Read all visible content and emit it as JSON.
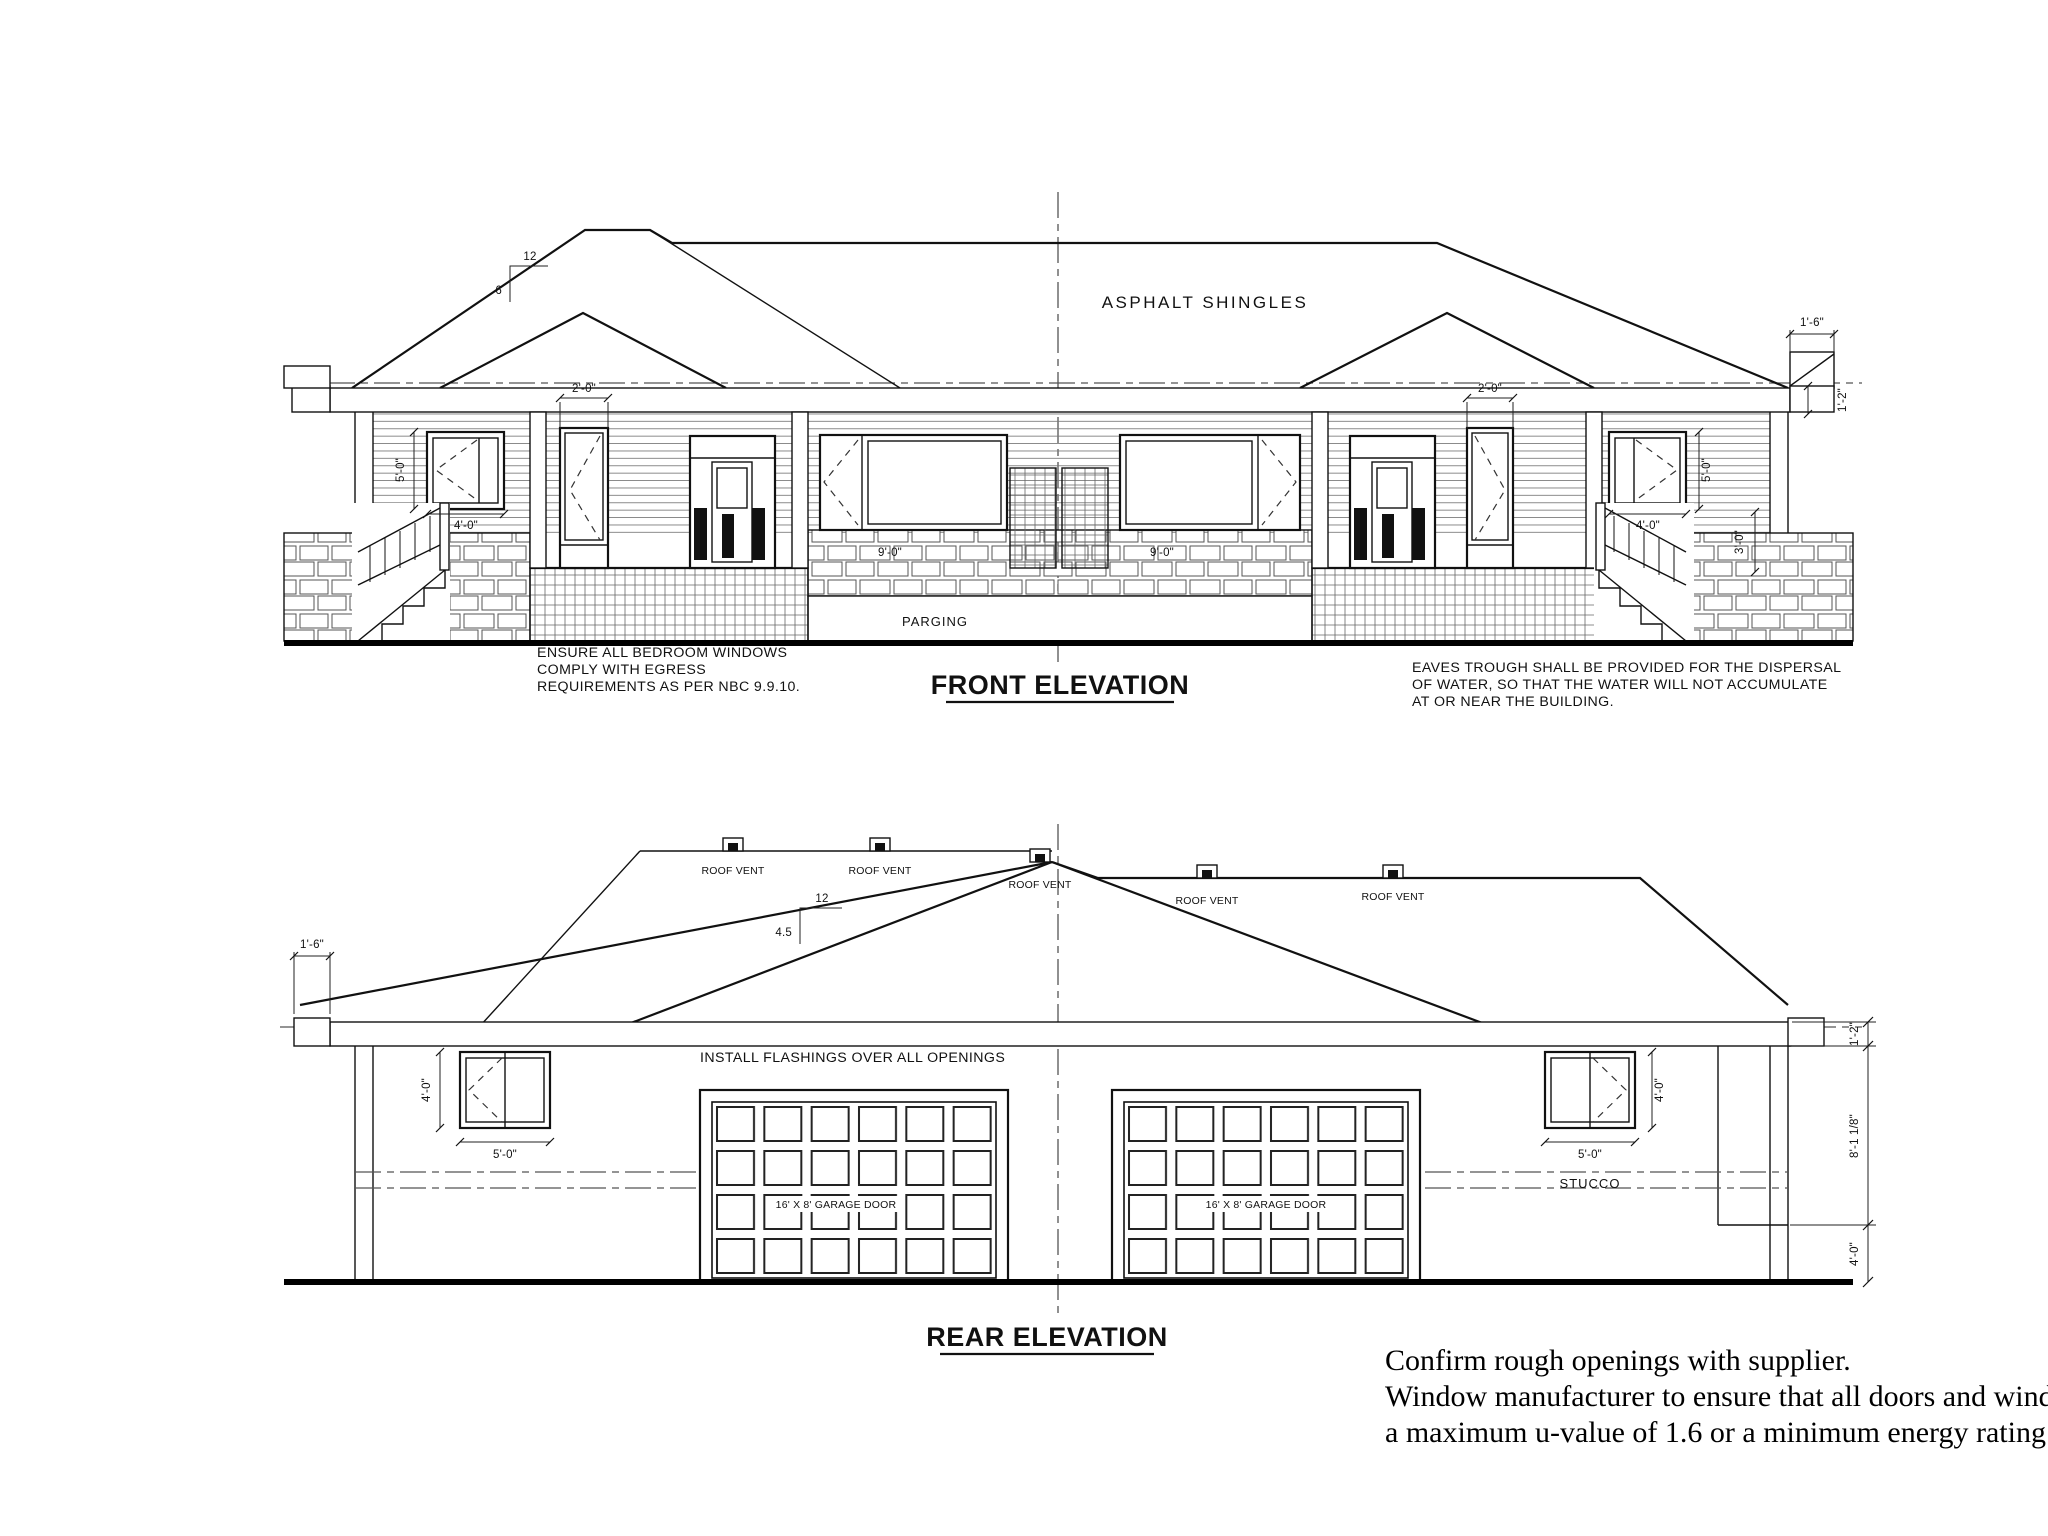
{
  "sheet": {
    "background": "#ffffff",
    "ink": "#111111"
  },
  "front": {
    "title": "FRONT ELEVATION",
    "roof_material": "ASPHALT SHINGLES",
    "parging": "PARGING",
    "slope_run": "12",
    "slope_rise": "6",
    "egress_note": [
      "ENSURE ALL BEDROOM WINDOWS",
      "COMPLY WITH EGRESS",
      "REQUIREMENTS AS PER NBC 9.9.10."
    ],
    "eaves_note": [
      "EAVES TROUGH SHALL BE PROVIDED FOR THE DISPERSAL",
      "OF WATER, SO THAT THE WATER WILL NOT ACCUMULATE",
      "AT OR NEAR THE BUILDING."
    ],
    "dims": {
      "overhang": "1'-6\"",
      "fascia": "1'-2\"",
      "rail_height": "3'-0\"",
      "porch_window_left": "2'-0\"",
      "porch_window_right": "2'-0\"",
      "corner_window_width_left": "4'-0\"",
      "corner_window_height_left": "5'-0\"",
      "corner_window_width_right": "4'-0\"",
      "corner_window_height_right": "5'-0\"",
      "stone_left": "9'-0\"",
      "stone_right": "9'-0\""
    }
  },
  "rear": {
    "title": "REAR ELEVATION",
    "flashing_note": "INSTALL FLASHINGS OVER ALL OPENINGS",
    "stucco": "STUCCO",
    "slope_run": "12",
    "slope_rise": "4.5",
    "garage_door_left": "16' X 8' GARAGE DOOR",
    "garage_door_right": "16' X 8' GARAGE DOOR",
    "roof_vents": [
      "ROOF VENT",
      "ROOF VENT",
      "ROOF VENT",
      "ROOF VENT",
      "ROOF VENT"
    ],
    "dims": {
      "overhang": "1'-6\"",
      "fascia": "1'-2\"",
      "wall_height": "8'-1 1/8\"",
      "foundation": "4'-0\"",
      "window_height_left": "4'-0\"",
      "window_width_left": "5'-0\"",
      "window_height_right": "4'-0\"",
      "window_width_right": "5'-0\""
    }
  },
  "supplier_note": [
    "Confirm rough openings with supplier.",
    "Window manufacturer to ensure that all doors and windows have",
    "a maximum u-value of 1.6 or a minimum energy rating of 25."
  ]
}
